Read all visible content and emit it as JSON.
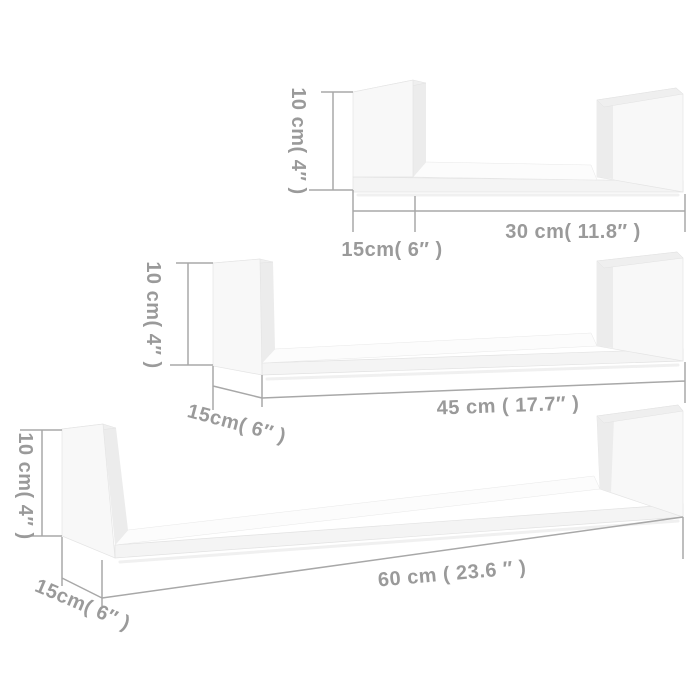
{
  "colors": {
    "background": "#ffffff",
    "dimension_line": "#a8a8a8",
    "dimension_text": "#9a9a9a",
    "shelf_white": "#f8f8f8"
  },
  "shelves": [
    {
      "height_label": "10 cm( 4″ )",
      "depth_label": "15cm( 6″ )",
      "width_label": "30 cm( 11.8″ )"
    },
    {
      "height_label": "10 cm( 4″ )",
      "depth_label": "15cm( 6″ )",
      "width_label": "45 cm ( 17.7″ )"
    },
    {
      "height_label": "10 cm( 4″ )",
      "depth_label": "15cm( 6″ )",
      "width_label": "60 cm ( 23.6 ″ )"
    }
  ]
}
